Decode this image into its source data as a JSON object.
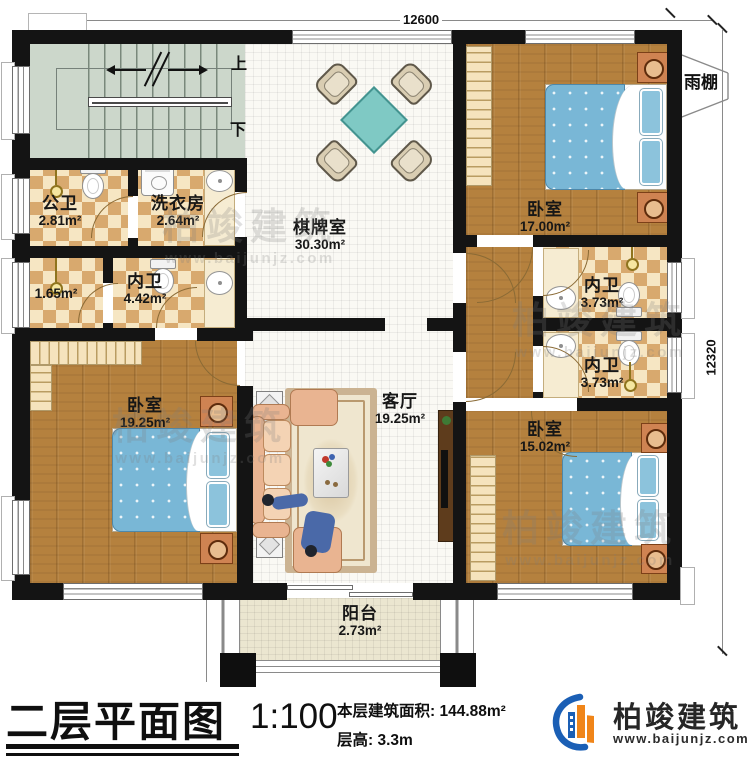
{
  "dims": {
    "top": "12600",
    "right": "12320"
  },
  "stair": {
    "up": "上",
    "down": "下"
  },
  "canopy_label": "雨棚",
  "rooms": [
    {
      "id": "gongwei",
      "name": "公卫",
      "area": "2.81m²"
    },
    {
      "id": "xiyifang",
      "name": "洗衣房",
      "area": "2.64m²"
    },
    {
      "id": "qipaishi",
      "name": "棋牌室",
      "area": "30.30m²"
    },
    {
      "id": "bedroom-tr",
      "name": "卧室",
      "area": "17.00m²"
    },
    {
      "id": "closet",
      "name": "",
      "area": "1.65m²"
    },
    {
      "id": "neiwei-w",
      "name": "内卫",
      "area": "4.42m²"
    },
    {
      "id": "neiwei-r1",
      "name": "内卫",
      "area": "3.73m²"
    },
    {
      "id": "neiwei-r2",
      "name": "内卫",
      "area": "3.73m²"
    },
    {
      "id": "bedroom-bl",
      "name": "卧室",
      "area": "19.25m²"
    },
    {
      "id": "keting",
      "name": "客厅",
      "area": "19.25m²"
    },
    {
      "id": "bedroom-br",
      "name": "卧室",
      "area": "15.02m²"
    },
    {
      "id": "yangtai",
      "name": "阳台",
      "area": "2.73m²"
    }
  ],
  "titleblock": {
    "title": "二层平面图",
    "scale": "1:100",
    "area_line": "本层建筑面积: 144.88m²",
    "height_line": "层高: 3.3m"
  },
  "logo": {
    "name": "柏竣建筑",
    "website": "www.baijunjz.com"
  },
  "watermark": {
    "text": "柏竣建筑",
    "sub": "www.baijunjz.com"
  },
  "colors": {
    "wall": "#141414",
    "wood": "#b5813e",
    "checker_dark": "#d8a96e",
    "checker_light": "#f6e6c3",
    "quilt_blue": "#79b7d6",
    "table_teal": "#7fc9c4",
    "logo_blue": "#1b5fb5",
    "logo_orange": "#f08519"
  }
}
